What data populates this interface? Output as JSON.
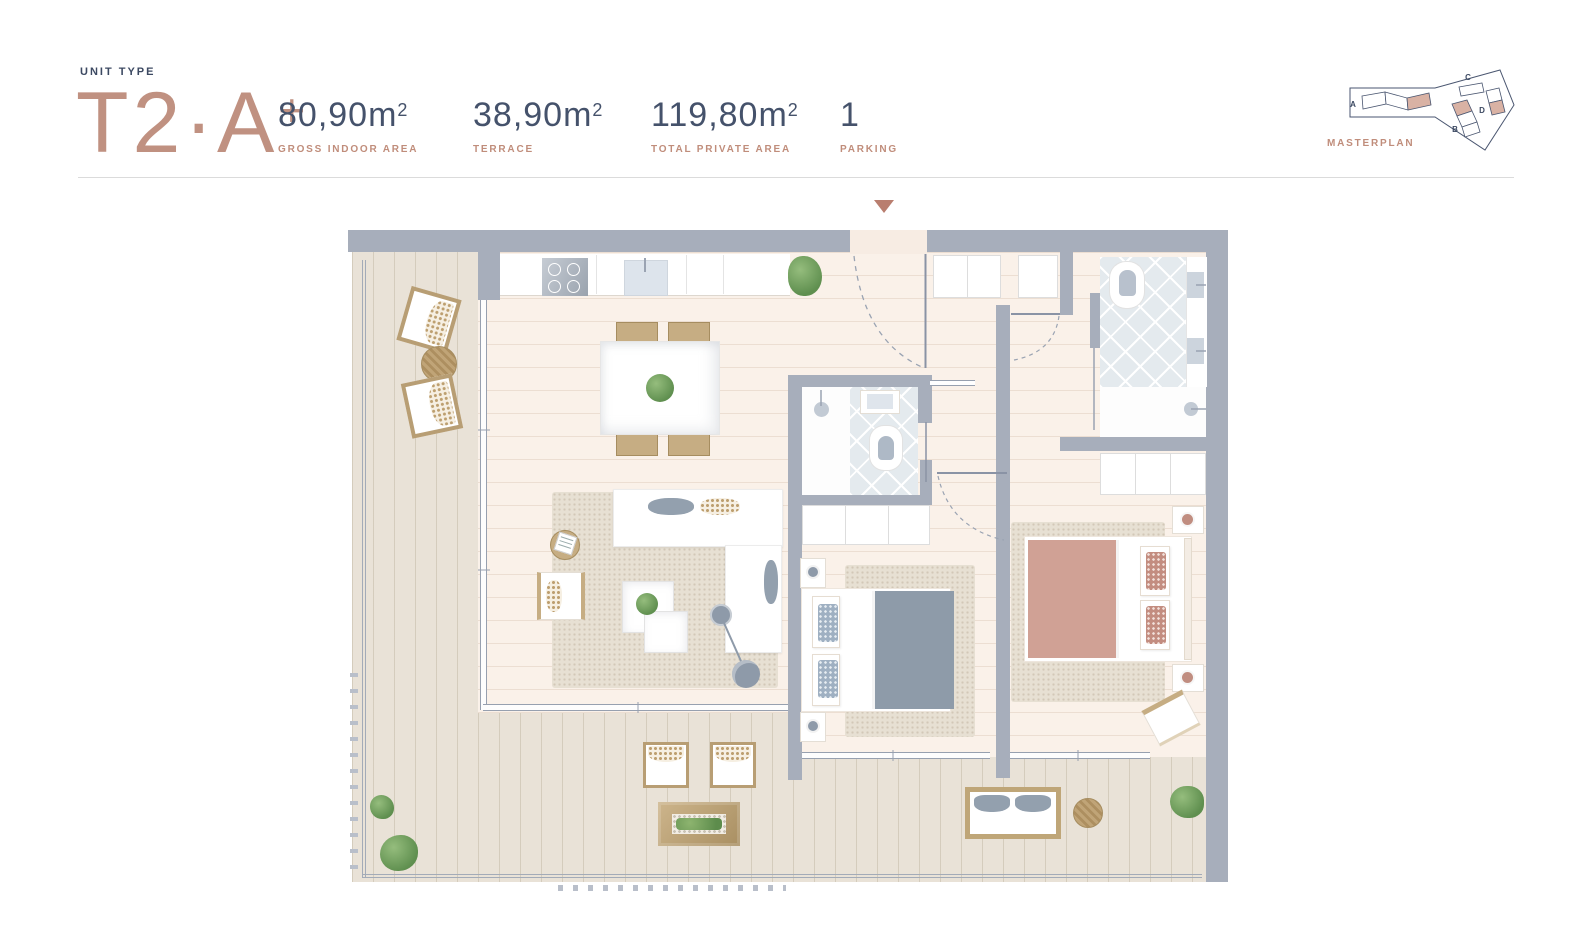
{
  "header": {
    "unit_type_label": "UNIT TYPE",
    "unit_type_name": "T2·A",
    "unit_type_suffix": "+",
    "stats": [
      {
        "value": "80,90m",
        "superscript": "2",
        "label": "GROSS INDOOR AREA"
      },
      {
        "value": "38,90m",
        "superscript": "2",
        "label": "TERRACE"
      },
      {
        "value": "119,80m",
        "superscript": "2",
        "label": "TOTAL PRIVATE AREA"
      },
      {
        "value": "1",
        "superscript": "",
        "label": "PARKING"
      }
    ]
  },
  "masterplan": {
    "label": "MASTERPLAN",
    "buildings": [
      {
        "id": "A"
      },
      {
        "id": "B"
      },
      {
        "id": "C"
      },
      {
        "id": "D"
      }
    ],
    "highlight_color": "#d9b2a4"
  },
  "icons": {
    "entrance_arrow": "triangle-down"
  },
  "colors": {
    "accent_rose": "#c08d7b",
    "navy": "#45526b",
    "wall_gray": "#a7aebb",
    "indoor_floor": "#faf1e9",
    "deck": "#e9e2d7",
    "bathroom_tile": "#e4eaee",
    "bed_duvet_gray": "#8e9ba9",
    "bed_duvet_rose": "#d0a195",
    "entrance_marker": "#b97e6f"
  }
}
